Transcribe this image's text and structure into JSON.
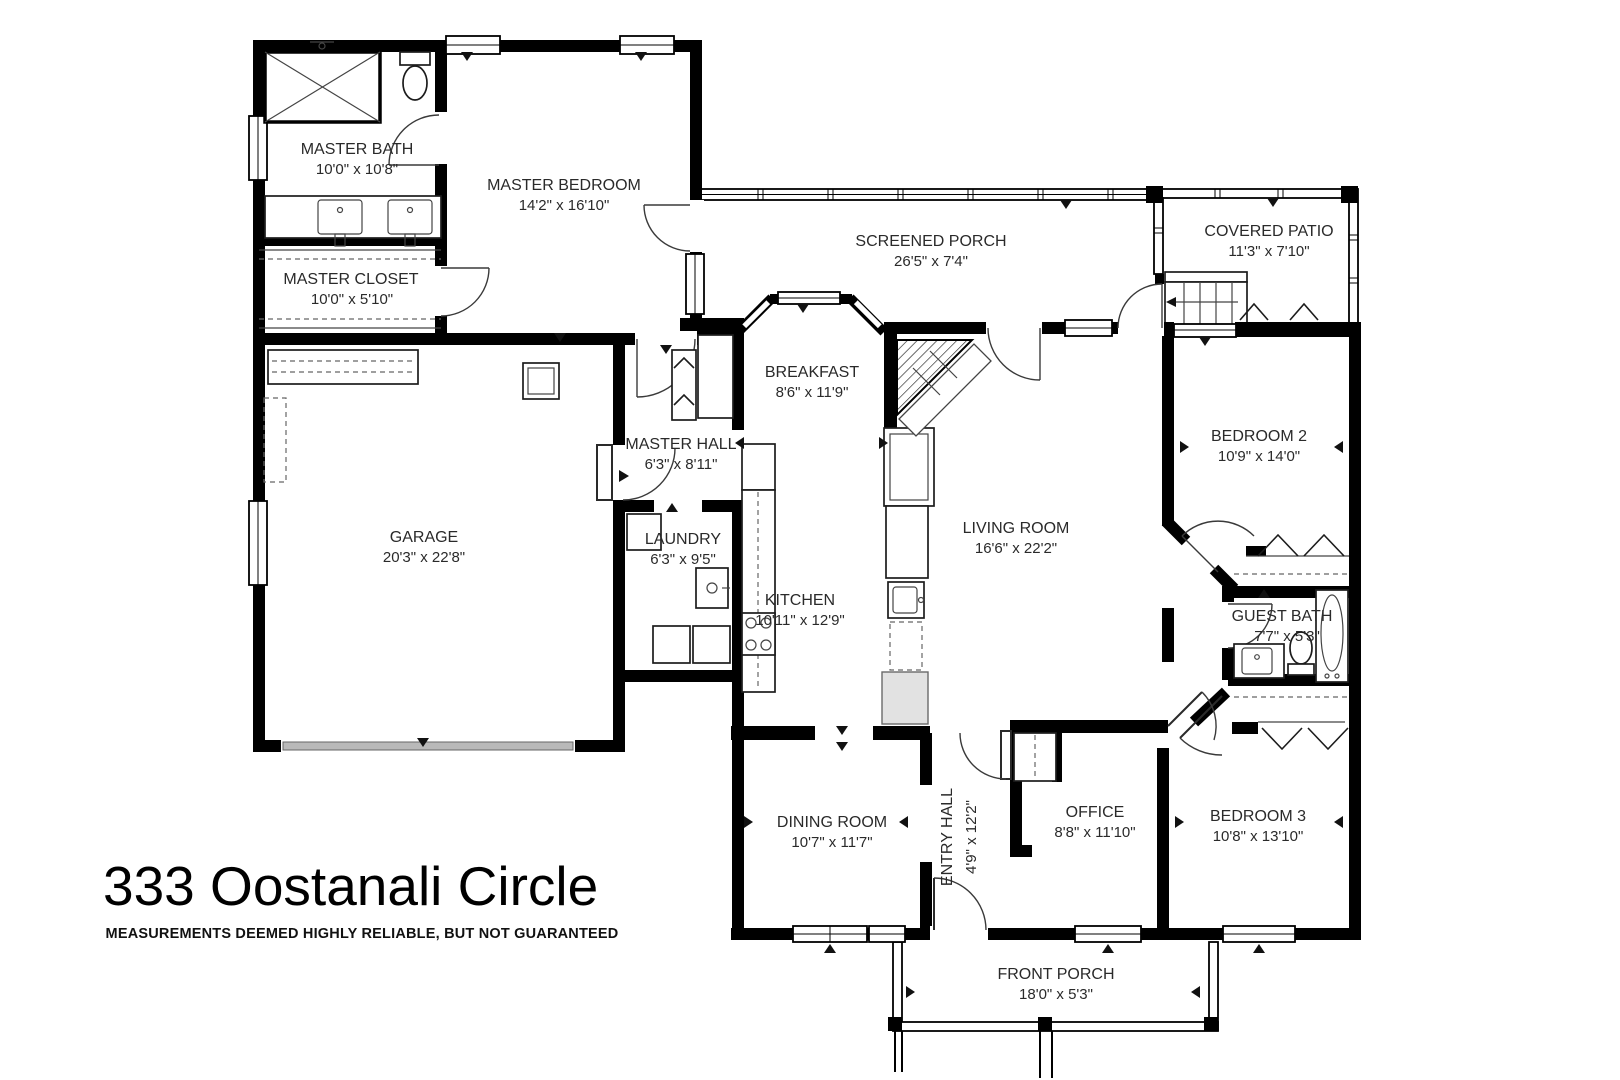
{
  "title": {
    "address": "333 Oostanali Circle",
    "disclaimer": "MEASUREMENTS DEEMED HIGHLY RELIABLE, BUT NOT GUARANTEED"
  },
  "colors": {
    "walls": "#000000",
    "background": "#ffffff",
    "label_text": "#2a2a2a",
    "garage_door_gray": "#b9b9b9",
    "cabinet_gray": "#e2e2e2"
  },
  "rooms": {
    "master_bath": {
      "name": "MASTER BATH",
      "dims": "10'0\" x 10'8\""
    },
    "master_closet": {
      "name": "MASTER CLOSET",
      "dims": "10'0\" x 5'10\""
    },
    "master_bedroom": {
      "name": "MASTER BEDROOM",
      "dims": "14'2\" x 16'10\""
    },
    "screened_porch": {
      "name": "SCREENED PORCH",
      "dims": "26'5\" x 7'4\""
    },
    "covered_patio": {
      "name": "COVERED PATIO",
      "dims": "11'3\" x 7'10\""
    },
    "breakfast": {
      "name": "BREAKFAST",
      "dims": "8'6\" x 11'9\""
    },
    "master_hall": {
      "name": "MASTER HALL",
      "dims": "6'3\" x 8'11\""
    },
    "garage": {
      "name": "GARAGE",
      "dims": "20'3\" x 22'8\""
    },
    "laundry": {
      "name": "LAUNDRY",
      "dims": "6'3\" x 9'5\""
    },
    "kitchen": {
      "name": "KITCHEN",
      "dims": "10'11\" x 12'9\""
    },
    "living_room": {
      "name": "LIVING ROOM",
      "dims": "16'6\" x 22'2\""
    },
    "bedroom_2": {
      "name": "BEDROOM 2",
      "dims": "10'9\" x 14'0\""
    },
    "guest_bath": {
      "name": "GUEST BATH",
      "dims": "7'7\" x 5'3\""
    },
    "dining_room": {
      "name": "DINING ROOM",
      "dims": "10'7\" x 11'7\""
    },
    "entry_hall": {
      "name": "ENTRY HALL",
      "dims": "4'9\" x 12'2\""
    },
    "office": {
      "name": "OFFICE",
      "dims": "8'8\" x 11'10\""
    },
    "bedroom_3": {
      "name": "BEDROOM 3",
      "dims": "10'8\" x 13'10\""
    },
    "front_porch": {
      "name": "FRONT PORCH",
      "dims": "18'0\" x 5'3\""
    }
  }
}
